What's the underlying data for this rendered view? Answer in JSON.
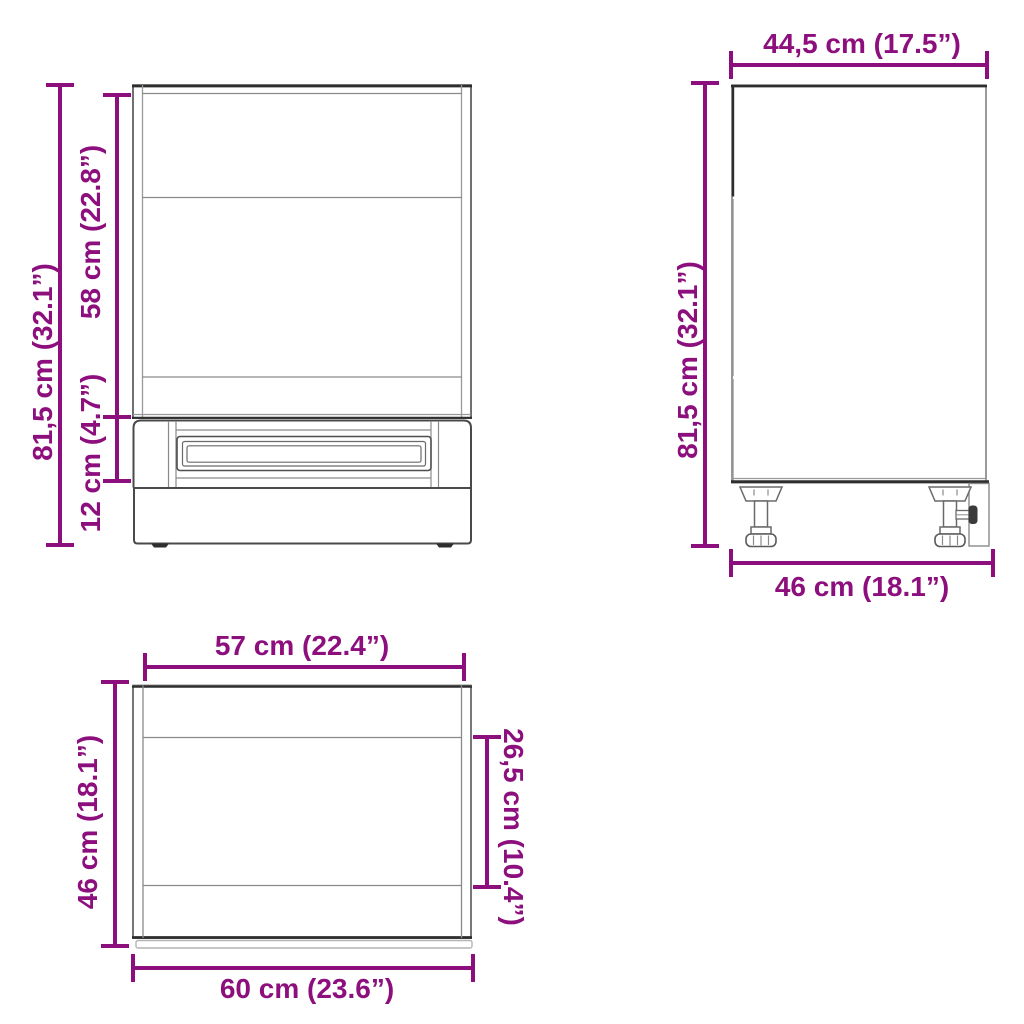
{
  "diagram_type": "furniture-dimension-drawing",
  "colors": {
    "dimension_accent": "#8C0F7D",
    "outline_dark": "#2E2E2E",
    "outline_medium": "#606060",
    "outline_light": "#9A9A9A",
    "background": "#FFFFFF"
  },
  "front_view": {
    "total_height_label": "81,5 cm (32.1”)",
    "upper_section_label": "58 cm (22.8”)",
    "drawer_section_label": "12 cm (4.7”)"
  },
  "side_view": {
    "top_depth_label": "44,5 cm (17.5”)",
    "total_height_label": "81,5 cm (32.1”)",
    "bottom_depth_label": "46 cm (18.1”)"
  },
  "top_view": {
    "inner_width_label": "57 cm (22.4”)",
    "depth_label": "46 cm (18.1”)",
    "recess_depth_label": "26,5 cm (10.4”)",
    "outer_width_label": "60 cm (23.6”)"
  }
}
